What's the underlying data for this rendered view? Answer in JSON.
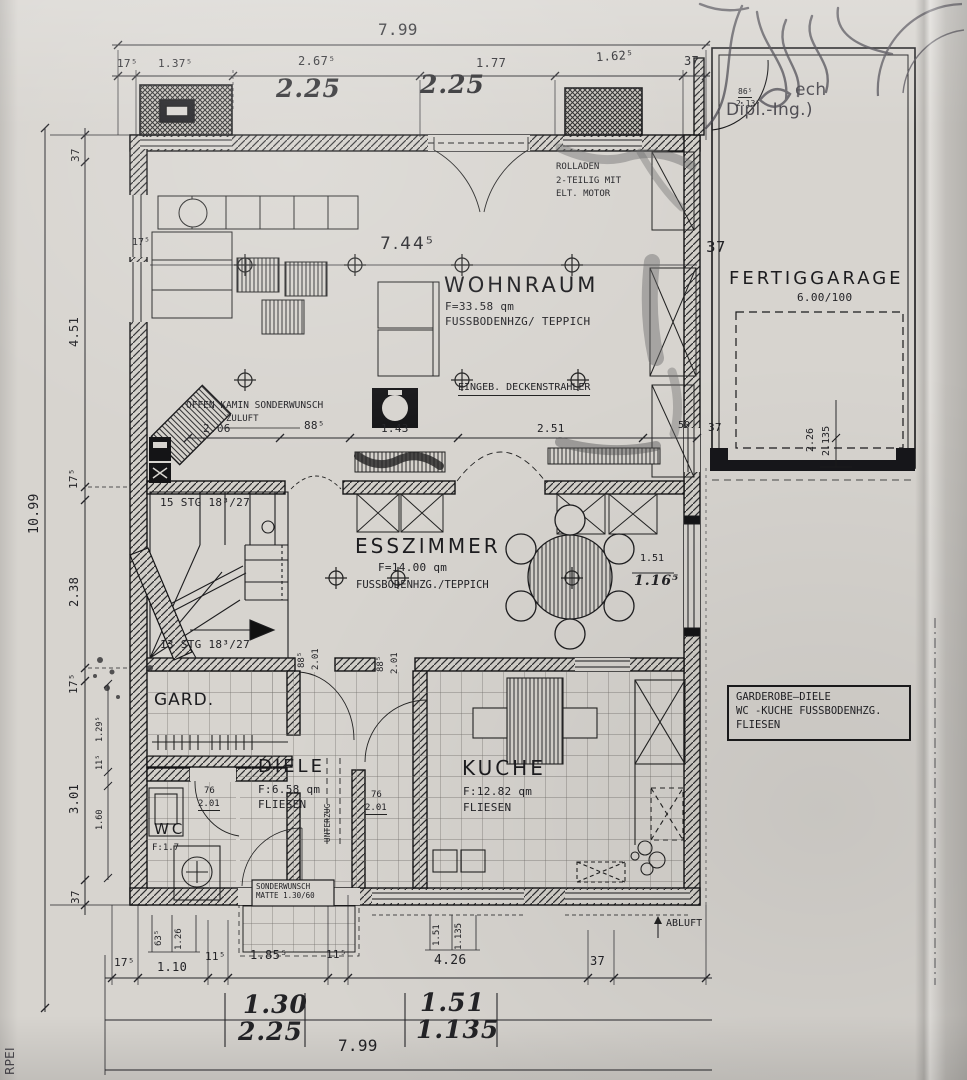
{
  "rooms": {
    "wohnraum": {
      "name": "WOHNRAUM",
      "area": "F=33.58 qm",
      "floor": "FUSSBODENHZG/ TEPPICH"
    },
    "esszimmer": {
      "name": "ESSZIMMER",
      "area": "F=14.00 qm",
      "floor": "FUSSBODENHZG./TEPPICH"
    },
    "kueche": {
      "name": "KUCHE",
      "area": "F:12.82 qm",
      "floor": "FLIESEN"
    },
    "diele": {
      "name": "DIELE",
      "area": "F:6.58 qm",
      "floor": "FLIESEN"
    },
    "wc": {
      "name": "WC",
      "area": "F:1.7"
    },
    "gard": {
      "name": "GARD."
    },
    "garage": {
      "name": "FERTIGGARAGE",
      "size": "6.00/100"
    }
  },
  "annotations": {
    "rolladen": [
      "ROLLADEN",
      "2-TEILIG MIT",
      "ELT. MOTOR"
    ],
    "kamin": "OFFEN KAMIN SONDERWUNSCH",
    "zuluft": "ZULUFT",
    "deckenstrahler": "EINGEB. DECKENSTRAHLER",
    "stairs_up": "15 STG 18³/27",
    "stairs_down": "13 STG 18³/27",
    "unterzug": "UNTERZUG",
    "abluft": "ABLUFT",
    "matte": [
      "SONDERWUNSCH",
      "MATTE 1.30/60"
    ],
    "note_box": [
      "GARDEROBE—DIELE",
      "WC -KUCHE FUSSBODENHZG.",
      "FLIESEN"
    ],
    "stamp": [
      "ech",
      "Dipl.-Ing.)"
    ],
    "margin_scribble": "RPEI"
  },
  "dims": {
    "top": {
      "overall": "7.99",
      "row": [
        "17⁵",
        "1.37⁵",
        "2.67⁵",
        "1.77",
        "1.62⁵",
        "37"
      ],
      "handwritten": [
        "2.25",
        "2.25"
      ]
    },
    "bottom": {
      "overall": "7.99",
      "row": [
        "17⁵",
        "1.10",
        "11⁵",
        "1.85⁵",
        "11⁵",
        "4.26",
        "37"
      ],
      "handwritten": [
        "1.30",
        "2.25",
        "1.51",
        "1.135"
      ],
      "small_vertical": [
        "63⁵",
        "1.26",
        "1.51",
        "1.135"
      ]
    },
    "left": {
      "overall": "10.99",
      "row": [
        "37",
        "4.51",
        "17⁵",
        "2.38",
        "17⁵",
        "3.01",
        "37"
      ],
      "small": [
        "1.29⁵",
        "11⁵",
        "1.60"
      ]
    },
    "mid": {
      "wohnraum_width": "7.44⁵",
      "wall": "37",
      "wall_thickness": "17⁵",
      "row": [
        "2.06",
        "88⁵",
        "1.43",
        "2.51",
        "50"
      ],
      "esszimmer": [
        "1.51",
        "1.16⁵"
      ]
    },
    "doors": {
      "esszimmer_a": [
        "88⁵",
        "2.01"
      ],
      "esszimmer_b": [
        "88⁵",
        "2.01"
      ],
      "wc": [
        "76",
        "2.01"
      ],
      "kueche": [
        "76",
        "2.01"
      ],
      "side": [
        "86⁵",
        "2.13⁵"
      ]
    },
    "garage": {
      "door": [
        "2.26",
        "2.135"
      ],
      "wall": "37"
    }
  }
}
